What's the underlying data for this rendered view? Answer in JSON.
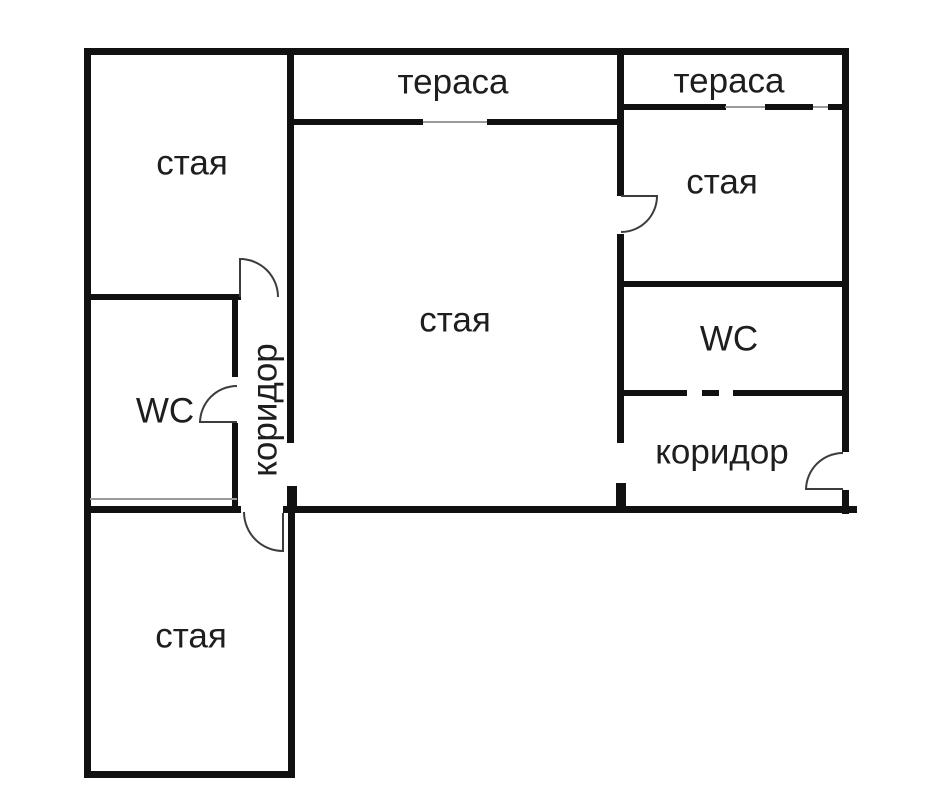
{
  "plan_title": "floor-plan",
  "rooms": [
    {
      "name": "room-top-left",
      "label": "стая"
    },
    {
      "name": "terrace-middle",
      "label": "тераса"
    },
    {
      "name": "terrace-right",
      "label": "тераса"
    },
    {
      "name": "room-right",
      "label": "стая"
    },
    {
      "name": "room-main",
      "label": "стая"
    },
    {
      "name": "wc-left",
      "label": "WC"
    },
    {
      "name": "corridor-left",
      "label": "коридор"
    },
    {
      "name": "wc-right",
      "label": "WC"
    },
    {
      "name": "corridor-right",
      "label": "коридор"
    },
    {
      "name": "room-bottom-left",
      "label": "стая"
    }
  ],
  "colors": {
    "background": "#ffffff",
    "wall": "#111111",
    "text": "#1e1e1e",
    "door_arc": "#3c3c3c",
    "window_thin": "#9a9a9a"
  }
}
